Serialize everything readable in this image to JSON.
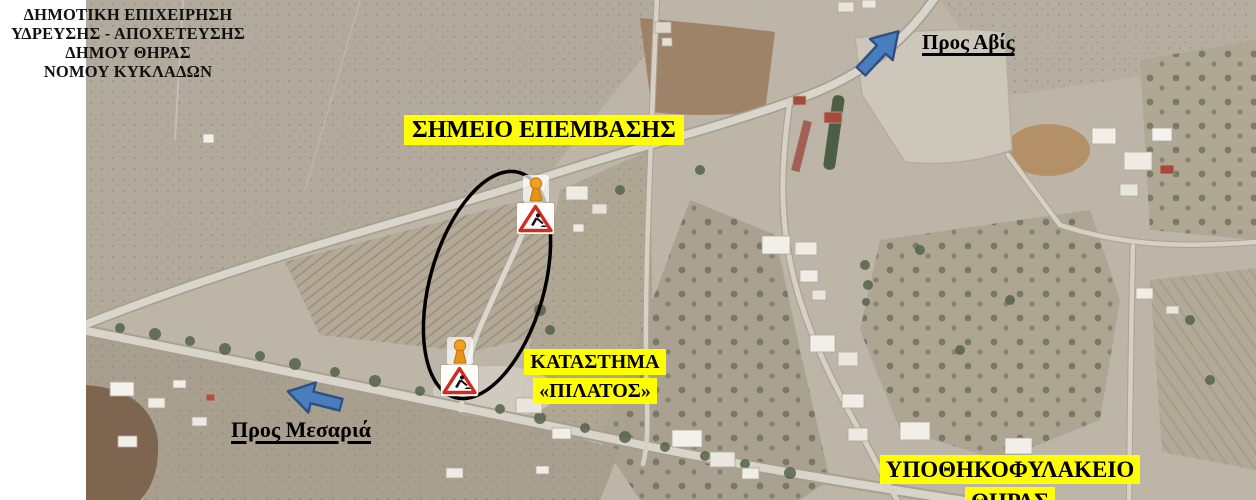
{
  "organization": {
    "lines": [
      "ΔΗΜΟΤΙΚΗ ΕΠΙΧΕΙΡΗΣΗ",
      "ΥΔΡΕΥΣΗΣ - ΑΠΟΧΕΤΕΥΣΗΣ",
      "ΔΗΜΟΥ ΘΗΡΑΣ",
      "ΝΟΜΟΥ ΚΥΚΛΑΔΩΝ"
    ]
  },
  "annotations": {
    "intervention_point_label": "ΣΗΜΕΙΟ ΕΠΕΜΒΑΣΗΣ",
    "store_label": {
      "line1": "ΚΑΤΑΣΤΗΜΑ",
      "line2": "«ΠΙΛΑΤΟΣ»"
    },
    "registry_label": {
      "line1": "ΥΠΟΘΗΚΟΦΥΛΑΚΕΙΟ",
      "line2": "ΘΗΡΑΣ"
    },
    "direction_northeast_label": "Προς Αβίς",
    "direction_southwest_label": "Προς Μεσαριά"
  },
  "map_markers": {
    "roadworks_signs_count": 2,
    "roadworks_sign_icon": "roadworks-warning-triangle",
    "beacon_icon": "orange-warning-beacon",
    "intervention_area_outline": "black-ellipse"
  },
  "colors": {
    "label_highlight": "#ffff00",
    "label_text": "#000000",
    "arrow_fill": "#4a7dbd",
    "arrow_outline": "#2d4f82",
    "ellipse_outline": "#000000",
    "sign_triangle_red": "#cf2b24",
    "beacon_orange": "#ef9d1c"
  }
}
